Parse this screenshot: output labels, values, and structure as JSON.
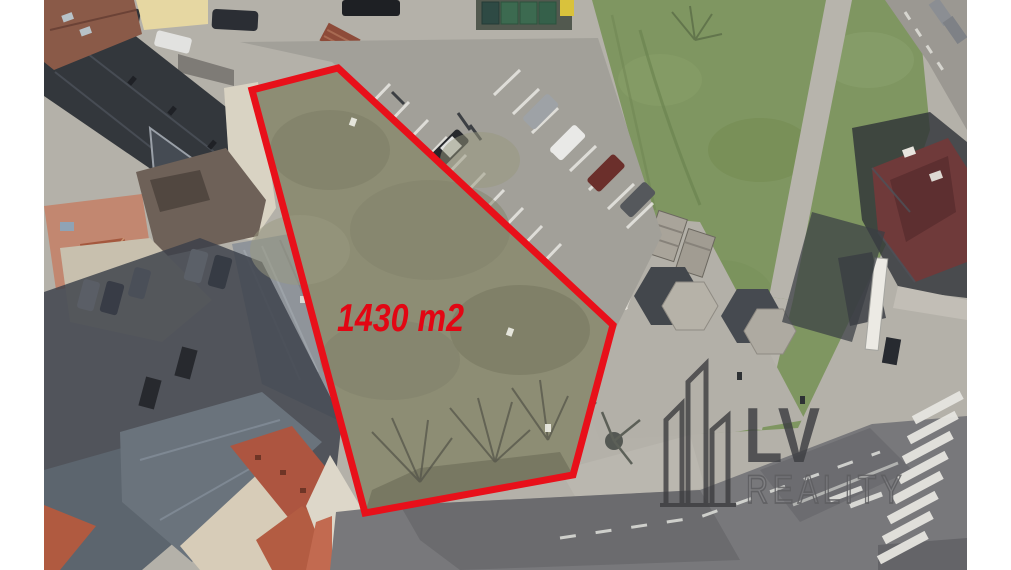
{
  "page": {
    "kind": "aerial-satellite-photo-with-property-outline",
    "white_margins": "left-and-right"
  },
  "plot": {
    "area_label": "1430 m2",
    "label_color": "#e20613",
    "outline_color": "#e8101a",
    "grass_color": "#8d8d74"
  },
  "watermark": {
    "brand_top": "LV",
    "brand_bottom": "REALITY",
    "color": "#3d3e42",
    "icon": "buildings-outline-icon"
  },
  "scene_colors": {
    "green_field": "#7f9661",
    "pavement": "#b4b1a9",
    "main_road": "#78787b",
    "dark_roofs": "#33373c",
    "red_tile_roof": "#b05a40",
    "house_hip_roof": "#6f3a3a",
    "shadow": "#3a4049"
  }
}
